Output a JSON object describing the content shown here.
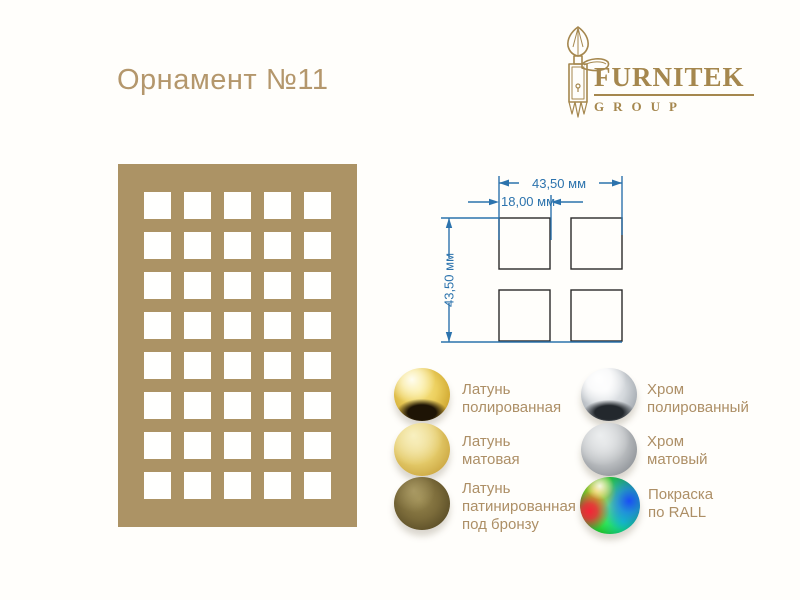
{
  "title": "Орнамент №11",
  "logo": {
    "brand": "FURNITEK",
    "group": "GROUP",
    "color": "#a5874e"
  },
  "ornament": {
    "rows": 8,
    "cols": 5,
    "panel_color": "#ac9365",
    "hole_color": "#ffffff"
  },
  "diagram": {
    "line_color": "#2c73ad",
    "square_color": "#2a2a2a",
    "width_label": "43,50 мм",
    "cell_label": "18,00 мм",
    "height_label": "43,50 мм"
  },
  "finishes": {
    "columns": [
      {
        "items": [
          {
            "name": "brass-polished",
            "line1": "Латунь",
            "line2": "полированная"
          },
          {
            "name": "brass-matte",
            "line1": "Латунь",
            "line2": "матовая"
          },
          {
            "name": "brass-patinated-bronze",
            "line1": "Латунь",
            "line2": "патинированная",
            "line3": "под бронзу"
          }
        ]
      },
      {
        "items": [
          {
            "name": "chrome-polished",
            "line1": "Хром",
            "line2": "полированный"
          },
          {
            "name": "chrome-matte",
            "line1": "Хром",
            "line2": "матовый"
          },
          {
            "name": "ral-paint",
            "line1": "Покраска",
            "line2": "по RALL"
          }
        ]
      }
    ]
  }
}
